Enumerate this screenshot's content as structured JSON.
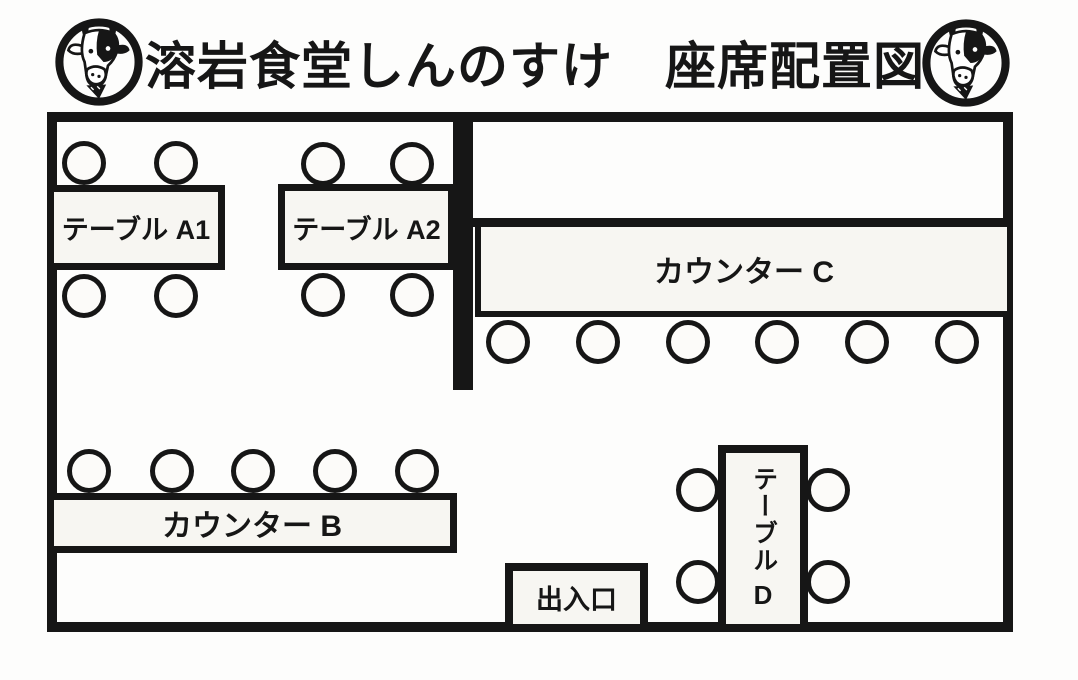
{
  "header": {
    "title": "溶岩食堂しんのすけ　座席配置図",
    "logo": "cow-face-stamp"
  },
  "colors": {
    "line": "#161616",
    "box_fill": "#f7f6f2",
    "background": "#fdfdfc"
  },
  "floor": {
    "tables": {
      "a1": {
        "label": "テーブル A1",
        "seats": 4
      },
      "a2": {
        "label": "テーブル A2",
        "seats": 4
      },
      "counter_c": {
        "label": "カウンター C",
        "seats": 6
      },
      "counter_b": {
        "label": "カウンター B",
        "seats": 5
      },
      "d": {
        "label": "テーブル D",
        "label_kana": "テーブル",
        "label_letter": "D",
        "seats": 4
      },
      "entrance": {
        "label": "出入口"
      }
    }
  }
}
